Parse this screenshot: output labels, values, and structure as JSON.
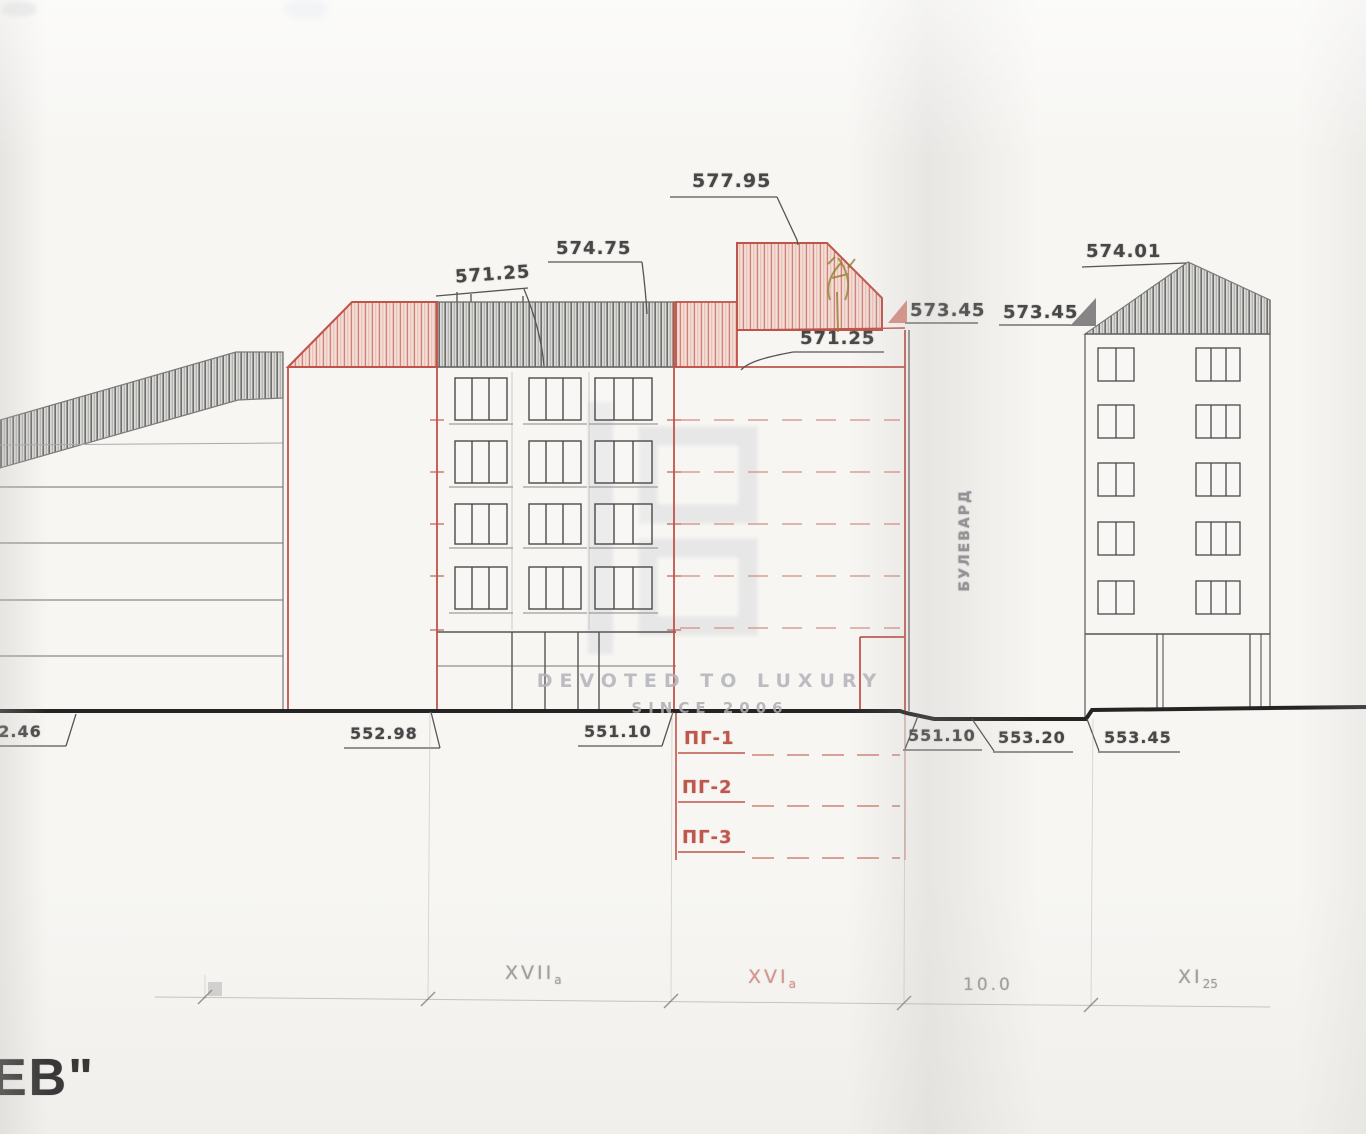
{
  "drawing": {
    "elevations": {
      "roof_left_mid": "571.25",
      "roof_mid": "574.75",
      "roof_top": "577.95",
      "terrace": "571.25",
      "parapet_a": "573.45",
      "parapet_b": "573.45",
      "roof_right": "574.01"
    },
    "ground_levels": {
      "g1": "552.46",
      "g2": "552.98",
      "g3": "551.10",
      "g4": "551.10",
      "g5": "553.20",
      "g6": "553.45"
    },
    "garage_levels": {
      "pg1": "ПГ-1",
      "pg2": "ПГ-2",
      "pg3": "ПГ-3"
    },
    "axes": {
      "a1_main": "XVII",
      "a1_sub": "а",
      "a2_main": "XVI",
      "a2_sub": "а",
      "a3": "10.0",
      "a4_main": "XI",
      "a4_sub": "25"
    },
    "street_name": "БУЛЕВАРД",
    "watermark": {
      "line1": "DEVOTED TO LUXURY",
      "line2": "SINCE 2006"
    },
    "title_fragment": "ЕВ\"",
    "colors": {
      "red_accent": "#bf584c",
      "pink_hatch": "#cf8377",
      "pencil": "#5f5f5f",
      "ground_line": "#222222",
      "watermark_gray": "#b2b2b8"
    }
  }
}
